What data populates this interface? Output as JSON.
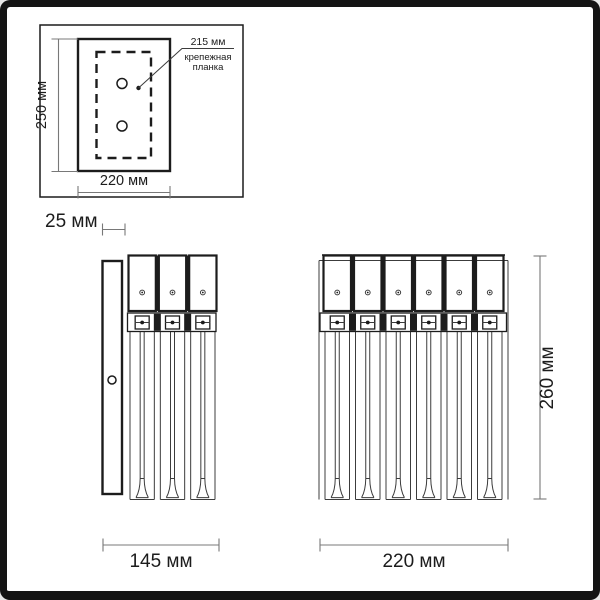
{
  "colors": {
    "background": "#ffffff",
    "frame": "#141414",
    "line": "#1c1c1c",
    "thin_line": "#3c3c3c",
    "dim_line": "#787878",
    "text": "#1c1c1c"
  },
  "labels": {
    "plate_height": "250 мм",
    "plate_width": "220 мм",
    "hole_spacing": "215 мм",
    "mount_plate_line1": "крепежная",
    "mount_plate_line2": "планка",
    "depth": "25 мм",
    "side_width": "145 мм",
    "front_width": "220 мм",
    "front_height": "260 мм"
  },
  "views": {
    "mounting_plate": {
      "holes": 2
    },
    "side": {
      "sections": 3
    },
    "front": {
      "sections": 6
    }
  }
}
